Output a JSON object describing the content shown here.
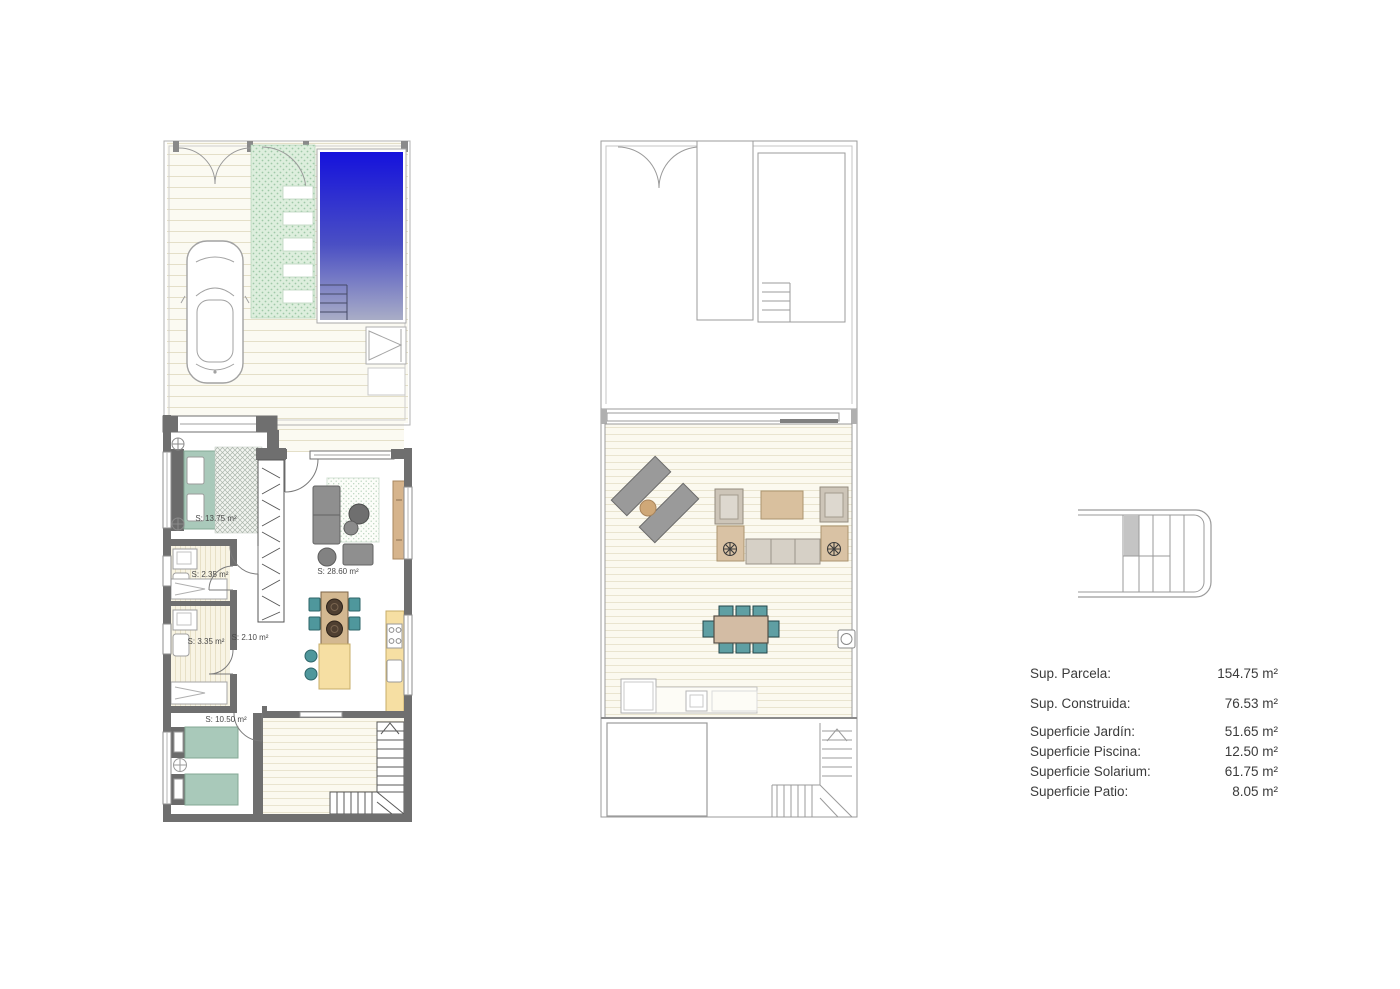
{
  "page": {
    "background": "#ffffff"
  },
  "ground_floor": {
    "rooms": [
      {
        "name": "master-bedroom",
        "label": "S: 13.75 m²"
      },
      {
        "name": "bathroom-1",
        "label": "S: 2.35 m²"
      },
      {
        "name": "bathroom-2",
        "label": "S: 3.35 m²"
      },
      {
        "name": "hallway",
        "label": "S: 2.10 m²"
      },
      {
        "name": "living-kitchen",
        "label": "S: 28.60 m²"
      },
      {
        "name": "bedroom-2",
        "label": "S: 10.50 m²"
      }
    ]
  },
  "summary": {
    "rows": [
      {
        "label": "Sup. Parcela:",
        "value": "154.75 m²"
      },
      {
        "label": "Sup. Construida:",
        "value": "76.53 m²"
      },
      {
        "label": "Superficie Jardín:",
        "value": "51.65 m²"
      },
      {
        "label": "Superficie Piscina:",
        "value": "12.50 m²"
      },
      {
        "label": "Superficie Solarium:",
        "value": "61.75 m²"
      },
      {
        "label": "Superficie Patio:",
        "value": "8.05 m²"
      }
    ]
  },
  "icons": {
    "locator": "plot-locator-icon"
  },
  "colors": {
    "pool_top": "#1512dc",
    "pool_bottom": "#a9adc6",
    "garden_green": "#ddeedd",
    "bed_green": "#a9c9ba",
    "teal_furniture": "#4f979c",
    "kitchen_yellow": "#f6dfa3",
    "wood_tan": "#d3bca4",
    "wall_gray": "#6f6f6f",
    "line_gray": "#9b9b9b"
  }
}
